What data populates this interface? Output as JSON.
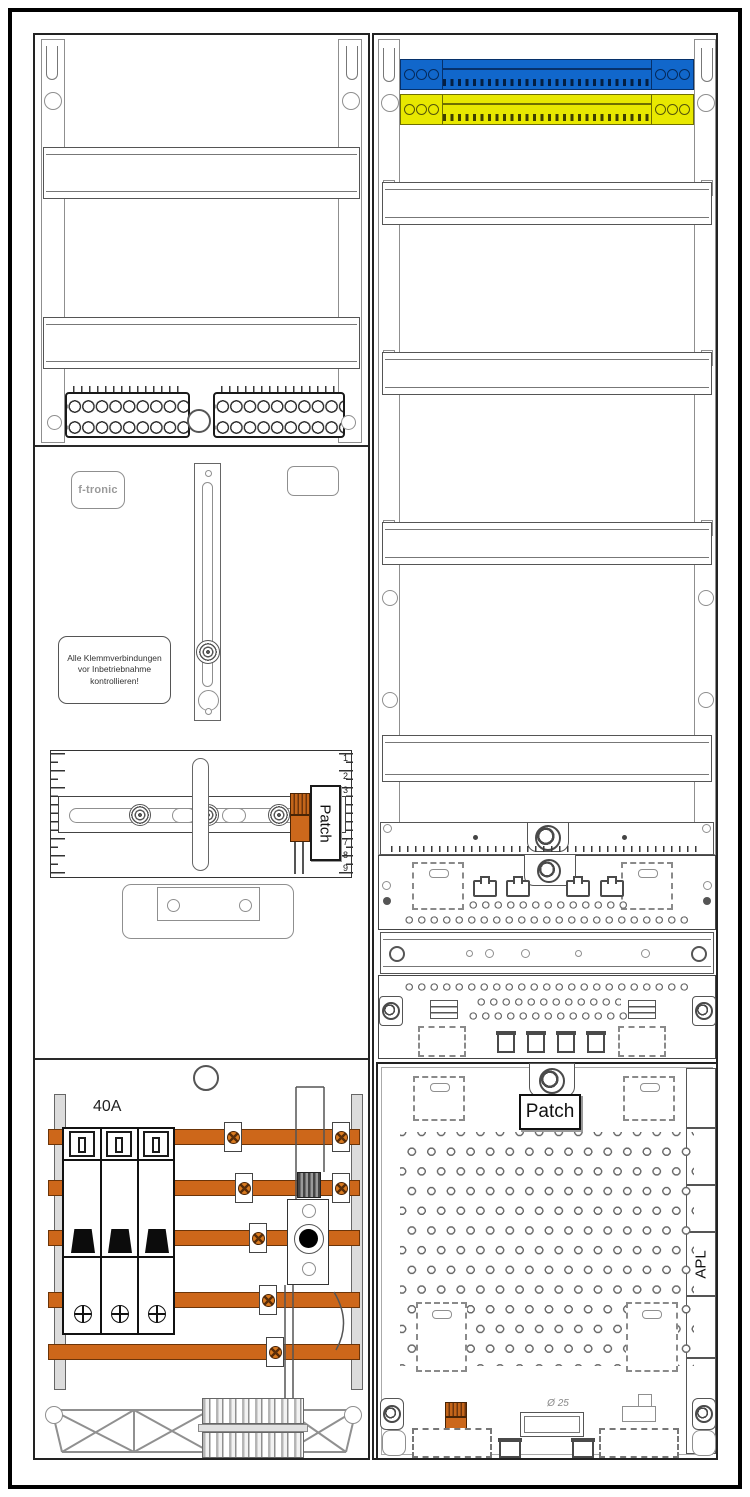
{
  "drawing_type": "meter-cabinet-wiring-diagram",
  "colors": {
    "neutral_busbar_blue": "#1167cb",
    "pe_busbar_yellow": "#e8e800",
    "power_busbar_orange": "#cd671a",
    "line": "#1a1a1a",
    "background": "#ffffff"
  },
  "left_column": {
    "brand_label": "f-tronic",
    "warning_lines": [
      "Alle Klemmverbindungen",
      "vor Inbetriebnahme",
      "kontrollieren!"
    ],
    "patch_label": "Patch",
    "ruler_numbers": [
      "1",
      "2",
      "3",
      "7",
      "8",
      "9"
    ],
    "breaker_rating": "40A"
  },
  "right_column": {
    "patch_label": "Patch",
    "apl_label": "APL",
    "knockout_diameter": "Ø 25"
  }
}
